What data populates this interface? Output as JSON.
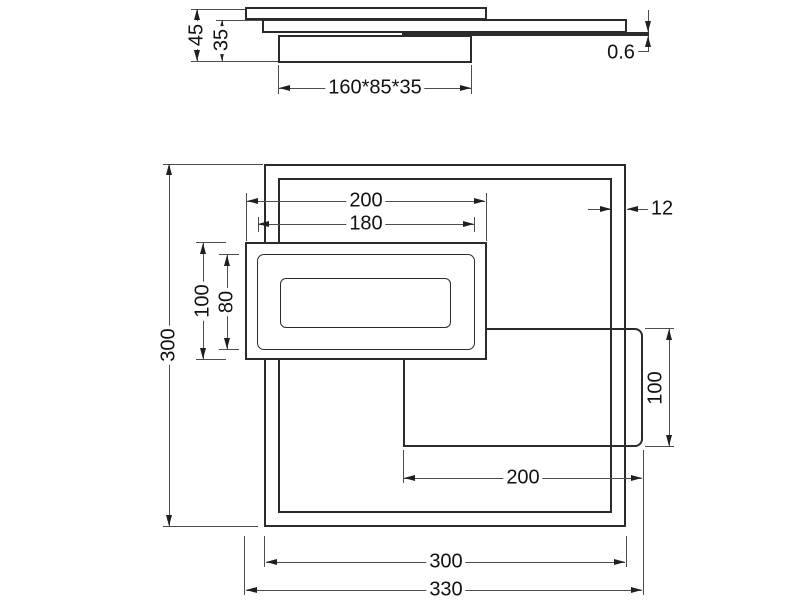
{
  "side_view": {
    "total_height": "45",
    "body_height": "35",
    "box_size": "160*85*35",
    "plate_thickness": "0.6"
  },
  "plan_view": {
    "frame_height": "300",
    "mid_width": "200",
    "mid_inner_width": "180",
    "frame_thickness": "12",
    "mid_height": "100",
    "mid_inner_height": "80",
    "right_height": "100",
    "right_width": "200",
    "frame_width": "300",
    "total_width": "330"
  }
}
